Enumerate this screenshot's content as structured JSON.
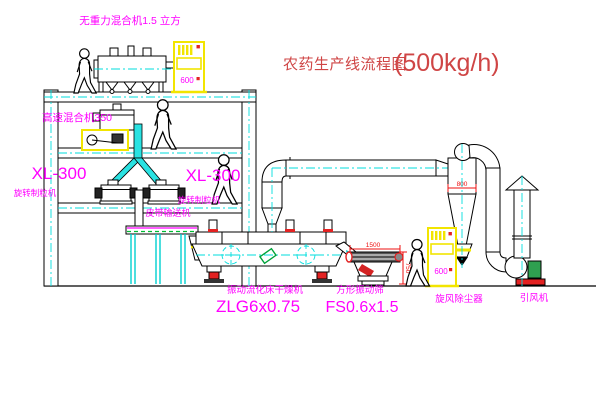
{
  "title": {
    "main": "农药生产线流程图",
    "capacity": "(500kg/h)"
  },
  "labels": {
    "gravity_mixer": "无重力混合机1.5 立方",
    "high_speed_mixer": "高速混合机350",
    "granulator_left_model": "XL-300",
    "granulator_left_name": "旋转制粒机",
    "granulator_right_model": "XL-300",
    "granulator_right_name": "旋转制粒机",
    "belt_conveyor": "皮带输送机",
    "dryer_name": "振动流化床干燥机",
    "dryer_model": "ZLG6x0.75",
    "screen_name": "方形振动筛",
    "screen_model": "FS0.6x1.5",
    "cyclone": "旋风除尘器",
    "fan": "引风机"
  },
  "dimensions": {
    "screen_length": "1500",
    "screen_height": "750",
    "cyclone_outlet": "800"
  },
  "control_panel": {
    "display": "600"
  },
  "colors": {
    "line": "#000000",
    "centerline": "#00dede",
    "label_magenta": "#ff00ff",
    "title_red": "#cf4545",
    "dimension_red": "#ee1111",
    "panel_yellow": "#f2e500",
    "pipe_cyan": "#2ae2e2",
    "motor_green": "#2fa050",
    "base_red": "#e32222"
  }
}
